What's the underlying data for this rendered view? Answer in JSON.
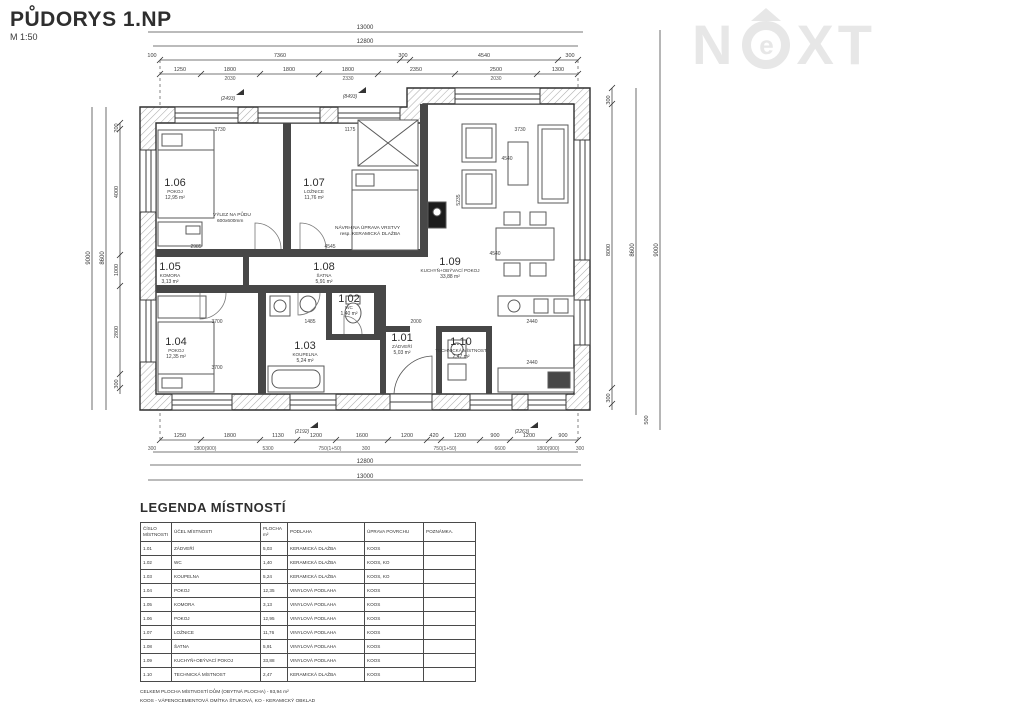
{
  "title": "PŮDORYS 1.NP",
  "scale": "M 1:50",
  "watermark": {
    "left": "N",
    "mid": "e",
    "right": "XT"
  },
  "plan": {
    "rooms": [
      {
        "id": "1.01",
        "name": "ZÁDVEŘÍ",
        "area": "5,03 m²"
      },
      {
        "id": "1.02",
        "name": "WC",
        "area": "1,40 m²"
      },
      {
        "id": "1.03",
        "name": "KOUPELNA",
        "area": "5,24 m²"
      },
      {
        "id": "1.04",
        "name": "POKOJ",
        "area": "12,35 m²"
      },
      {
        "id": "1.05",
        "name": "KOMORA",
        "area": "3,13 m²"
      },
      {
        "id": "1.06",
        "name": "POKOJ",
        "area": "12,95 m²"
      },
      {
        "id": "1.07",
        "name": "LOŽNICE",
        "area": "11,76 m²"
      },
      {
        "id": "1.08",
        "name": "ŠATNA",
        "area": "5,91 m²"
      },
      {
        "id": "1.09",
        "name": "KUCHYŇ+OBÝVACÍ POKOJ",
        "area": "33,88 m²"
      },
      {
        "id": "1.10",
        "name": "TECHNICKÁ MÍSTNOST",
        "area": "2,47 m²"
      }
    ],
    "annotations": {
      "attic_line1": "VÝLEZ NA PŮDU",
      "attic_line2": "600x600mm",
      "floor_note_line1": "NÁVRH NA ÚPRAVA VRSTVY",
      "floor_note_line2": "resp. KERAMICKÁ DLAŽBA"
    },
    "interior_dims": [
      "3730",
      "1175",
      "3730",
      "4540",
      "5235",
      "4545",
      "2985",
      "2000",
      "1485",
      "2440",
      "2440",
      "3700",
      "3700",
      "4540"
    ]
  },
  "dims": {
    "top": {
      "total": "13000",
      "inner": "12800",
      "row3": [
        "100",
        "7360",
        "300",
        "4540",
        "300"
      ],
      "row4": [
        "1250",
        "1800",
        "1800",
        "1800",
        "2350",
        "2500",
        "1300"
      ],
      "row4_sub": [
        "2030",
        "2330",
        "2030"
      ]
    },
    "bottom": {
      "row1": [
        "1250",
        "1800",
        "1130",
        "1200",
        "1600",
        "1200",
        "420",
        "1200",
        "900",
        "1200",
        "900"
      ],
      "row2": [
        "300",
        "1800(900)",
        "5300",
        "750(1+50)",
        "300",
        "750(1+50)",
        "6600",
        "1800(900)",
        "300"
      ],
      "inner": "12800",
      "total": "13000"
    },
    "left": {
      "totals": [
        "9000",
        "8600"
      ],
      "segments": [
        "200",
        "4000",
        "1000",
        "2800",
        "300"
      ]
    },
    "right": {
      "segments": [
        "300",
        "8000",
        "300"
      ],
      "totals": [
        "8600",
        "9000"
      ],
      "extra": "500"
    },
    "section_marks": [
      "(2493)",
      "(8493)",
      "(2192)",
      "(2263)"
    ]
  },
  "legend": {
    "title": "LEGENDA MÍSTNOSTÍ",
    "headers": [
      "ČÍSLO MÍSTNOSTI",
      "ÚČEL MÍSTNOSTI",
      "PLOCHA m²",
      "PODLAHA",
      "ÚPRAVA POVRCHU",
      "POZNÁMKA."
    ],
    "rows": [
      [
        "1.01",
        "ZÁDVEŘÍ",
        "5,03",
        "KERAMICKÁ DLAŽBA",
        "KOOS",
        ""
      ],
      [
        "1.02",
        "WC",
        "1,40",
        "KERAMICKÁ DLAŽBA",
        "KOOS, KO",
        ""
      ],
      [
        "1.03",
        "KOUPELNA",
        "5,24",
        "KERAMICKÁ DLAŽBA",
        "KOOS, KO",
        ""
      ],
      [
        "1.04",
        "POKOJ",
        "12,35",
        "VINYLOVÁ PODLAHA",
        "KOOS",
        ""
      ],
      [
        "1.05",
        "KOMORA",
        "3,13",
        "VINYLOVÁ PODLAHA",
        "KOOS",
        ""
      ],
      [
        "1.06",
        "POKOJ",
        "12,95",
        "VINYLOVÁ PODLAHA",
        "KOOS",
        ""
      ],
      [
        "1.07",
        "LOŽNICE",
        "11,76",
        "VINYLOVÁ PODLAHA",
        "KOOS",
        ""
      ],
      [
        "1.08",
        "ŠATNA",
        "5,91",
        "VINYLOVÁ PODLAHA",
        "KOOS",
        ""
      ],
      [
        "1.09",
        "KUCHYŇ+OBÝVACÍ POKOJ",
        "33,88",
        "VINYLOVÁ PODLAHA",
        "KOOS",
        ""
      ],
      [
        "1.10",
        "TECHNICKÁ MÍSTNOST",
        "2,47",
        "KERAMICKÁ DLAŽBA",
        "KOOS",
        ""
      ]
    ],
    "footnotes": [
      "CELKEM PLOCHA MÍSTNOSTÍ DŮM  (OBYTNÁ PLOCHA) - 93,94 m²",
      "KOOS - VÁPENOCEMENTOVÁ OMÍTKA ŠTUKOVÁ, KO - KERAMICKÝ OBKLAD"
    ]
  }
}
